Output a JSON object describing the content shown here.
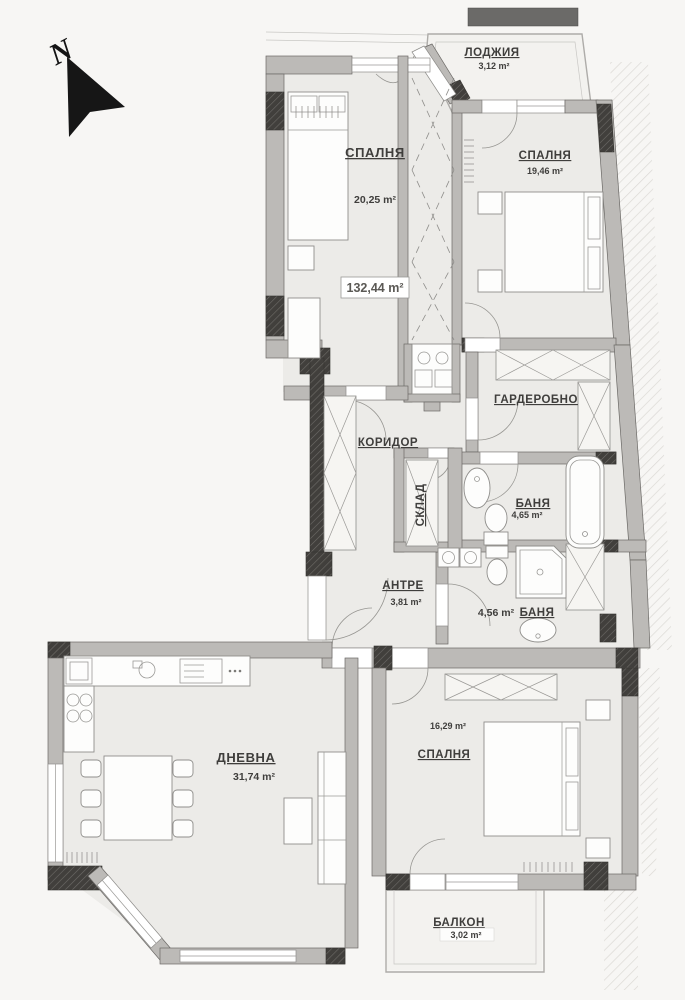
{
  "compass": {
    "label": "N"
  },
  "total_area": {
    "value": "132,44 m²"
  },
  "rooms": {
    "bedroom1": {
      "name": "СПАЛНЯ",
      "area": "20,25 m²"
    },
    "bedroom2": {
      "name": "СПАЛНЯ",
      "area": "19,46 m²"
    },
    "loggia": {
      "name": "ЛОДЖИЯ",
      "area": "3,12 m²"
    },
    "wardrobe": {
      "name": "ГАРДЕРОБНО",
      "area": ""
    },
    "corridor": {
      "name": "КОРИДОР",
      "area": ""
    },
    "storage": {
      "name": "СКЛАД",
      "area": ""
    },
    "bathroom1": {
      "name": "БАНЯ",
      "area": "4,65 m²"
    },
    "entry": {
      "name": "АНТРЕ",
      "area": "3,81 m²"
    },
    "bathroom2": {
      "name": "БАНЯ",
      "area": "4,56 m²"
    },
    "living": {
      "name": "ДНЕВНА",
      "area": "31,74 m²"
    },
    "bedroom3": {
      "name": "СПАЛНЯ",
      "area": "16,29 m²"
    },
    "balcony": {
      "name": "БАЛКОН",
      "area": "3,02 m²"
    }
  },
  "colors": {
    "background": "#f7f6f4",
    "floor": "#ecebe8",
    "wall": "#bcbab7",
    "dark_wall": "#413f3c",
    "text": "#3f3e3c"
  }
}
